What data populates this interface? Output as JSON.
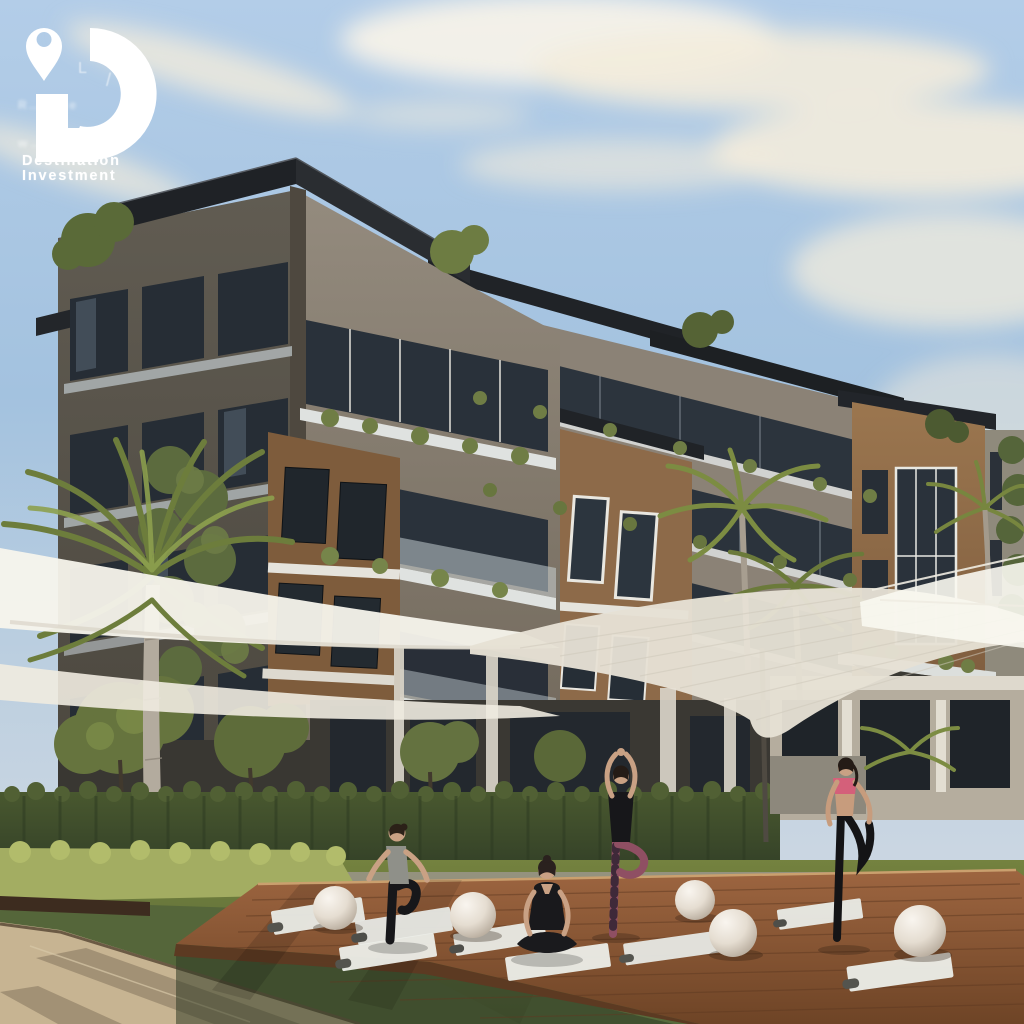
{
  "image": {
    "kind": "architectural exterior render",
    "scene_summary": "Modern apartment complex with stepped dark roofs, brown brick volumes, planted balconies and rooftop trees; white shade sails stretch over an outdoor wooden yoga deck where four women exercise among white spheres and yoga mats; palm trees, a tall hedge, lawn and a stone path in the foreground under a blue sky with wispy clouds.",
    "palette": {
      "sky": "#a9c4de",
      "cloud": "#f1e9d8",
      "roof": "#22252a",
      "facade_dark": "#55504a",
      "facade_light": "#8b8276",
      "brick": "#8d6a49",
      "glass": "#2a323b",
      "balcony": "#dfe2e0",
      "greenery": "#66743e",
      "hedge": "#3d4b2f",
      "lawn": "#5f7040",
      "deck": "#8a5636",
      "mat": "#e9ebe6",
      "sphere": "#ece5dc",
      "sail": "#f5f2ea",
      "skin": "#c9a184",
      "outfit_dark": "#17171a",
      "outfit_pink": "#d4607a",
      "path": "#c7b492"
    },
    "elements": [
      "sky",
      "clouds",
      "apartment-buildings",
      "balconies",
      "rooftop-trees",
      "palm-trees",
      "shade-sails",
      "hedge",
      "lawn",
      "stone-path",
      "wooden-deck",
      "yoga-mats",
      "white-spheres",
      "yoga-people"
    ]
  },
  "watermark": {
    "brand_line1": "Destination",
    "brand_line2": "Investment",
    "faint_glyph1": "L",
    "faint_glyph2": "/",
    "faint_line1": "R…ance",
    "faint_line2": "w………m",
    "logo_color": "#ffffff"
  },
  "people": [
    {
      "pose": "standing balance, arms extended",
      "outfit": "grey top, black leggings"
    },
    {
      "pose": "seated lotus meditation",
      "outfit": "black tank top"
    },
    {
      "pose": "tree pose, arms overhead",
      "outfit": "black tank, patterned pink leggings"
    },
    {
      "pose": "standing quad stretch",
      "outfit": "pink sports top, black leggings"
    }
  ]
}
